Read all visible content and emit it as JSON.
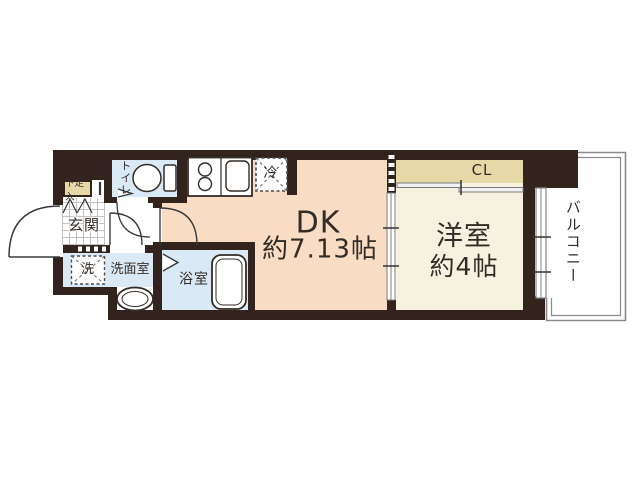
{
  "floorplan": {
    "type": "apartment-floorplan",
    "colors": {
      "wall": "#32241d",
      "dk_fill": "#f8dcc4",
      "bedroom_fill": "#f7f1df",
      "wet_area_fill": "#d9e9f5",
      "closet_fill": "#e7d8a8",
      "balcony_border": "#8a8a8a",
      "text": "#332b26"
    },
    "rooms": {
      "dk": {
        "label": "DK",
        "size": "約7.13帖"
      },
      "bedroom": {
        "label": "洋室",
        "size": "約4帖"
      },
      "balcony": {
        "label": "バルコニー"
      },
      "closet": {
        "label": "CL"
      },
      "toilet": {
        "label": "トイレ"
      },
      "entrance": {
        "label": "玄関"
      },
      "shoe_cabinet": {
        "label": "下足入"
      },
      "washer": {
        "label": "洗"
      },
      "washroom": {
        "label": "洗面室"
      },
      "bathroom": {
        "label": "浴室"
      },
      "refrigerator": {
        "label": "冷"
      }
    },
    "fixtures": [
      "entrance-door-arc",
      "toilet-icon",
      "kitchen-stove-icon",
      "kitchen-sink-icon",
      "refrigerator-box",
      "washer-box",
      "bathtub-icon",
      "washbasin-icon",
      "sliding-door",
      "closet-sliding-door",
      "balcony-window"
    ]
  }
}
